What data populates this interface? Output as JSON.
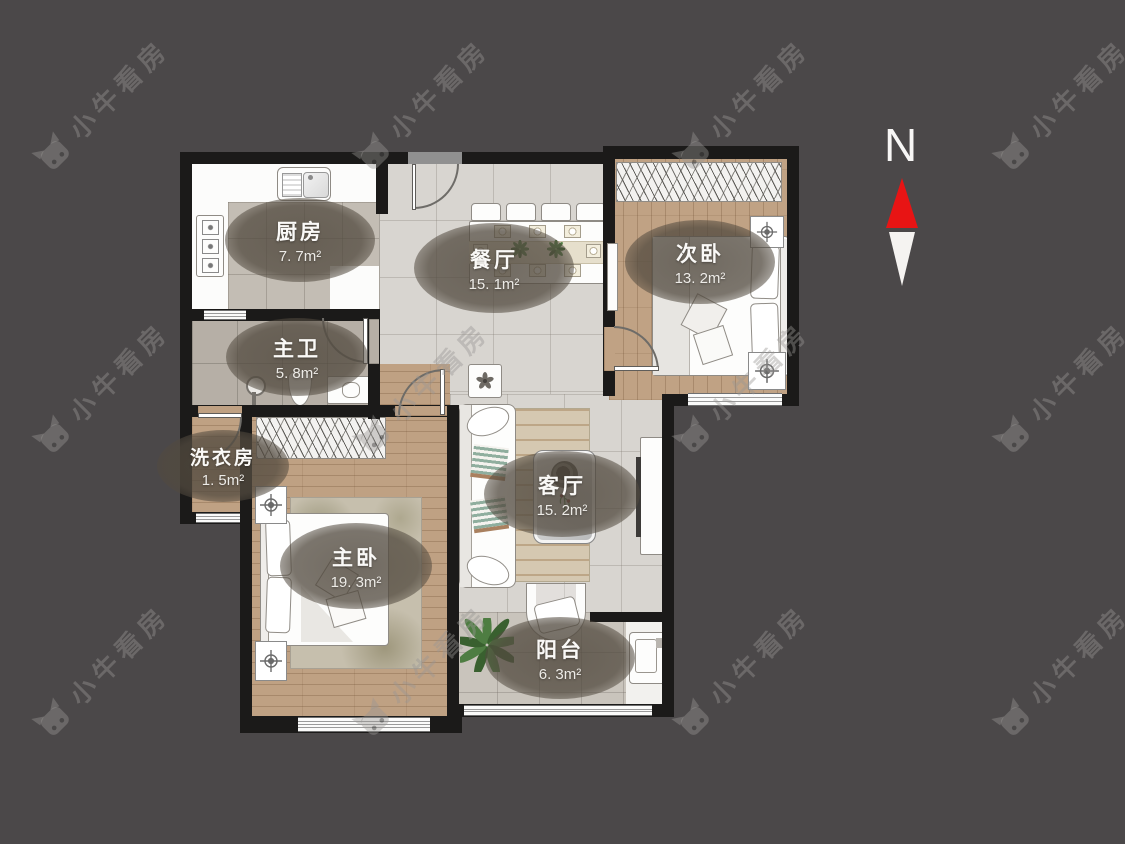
{
  "watermark": {
    "text": "小牛看房"
  },
  "compass": {
    "label": "N"
  },
  "rooms": {
    "kitchen": {
      "name": "厨房",
      "area": "7. 7m²"
    },
    "dining": {
      "name": "餐厅",
      "area": "15. 1m²"
    },
    "second_bedroom": {
      "name": "次卧",
      "area": "13. 2m²"
    },
    "master_bath": {
      "name": "主卫",
      "area": "5. 8m²"
    },
    "laundry": {
      "name": "洗衣房",
      "area": "1. 5m²"
    },
    "master_bedroom": {
      "name": "主卧",
      "area": "19. 3m²"
    },
    "living": {
      "name": "客厅",
      "area": "15. 2m²"
    },
    "balcony": {
      "name": "阳台",
      "area": "6. 3m²"
    }
  },
  "colors": {
    "background": "#4b4849",
    "wall": "#1b1a19",
    "compass_north_red": "#e81414",
    "wood_floor": "#c0a284",
    "marble_floor": "#d8d5d0",
    "label_bubble": "#524a3f"
  }
}
